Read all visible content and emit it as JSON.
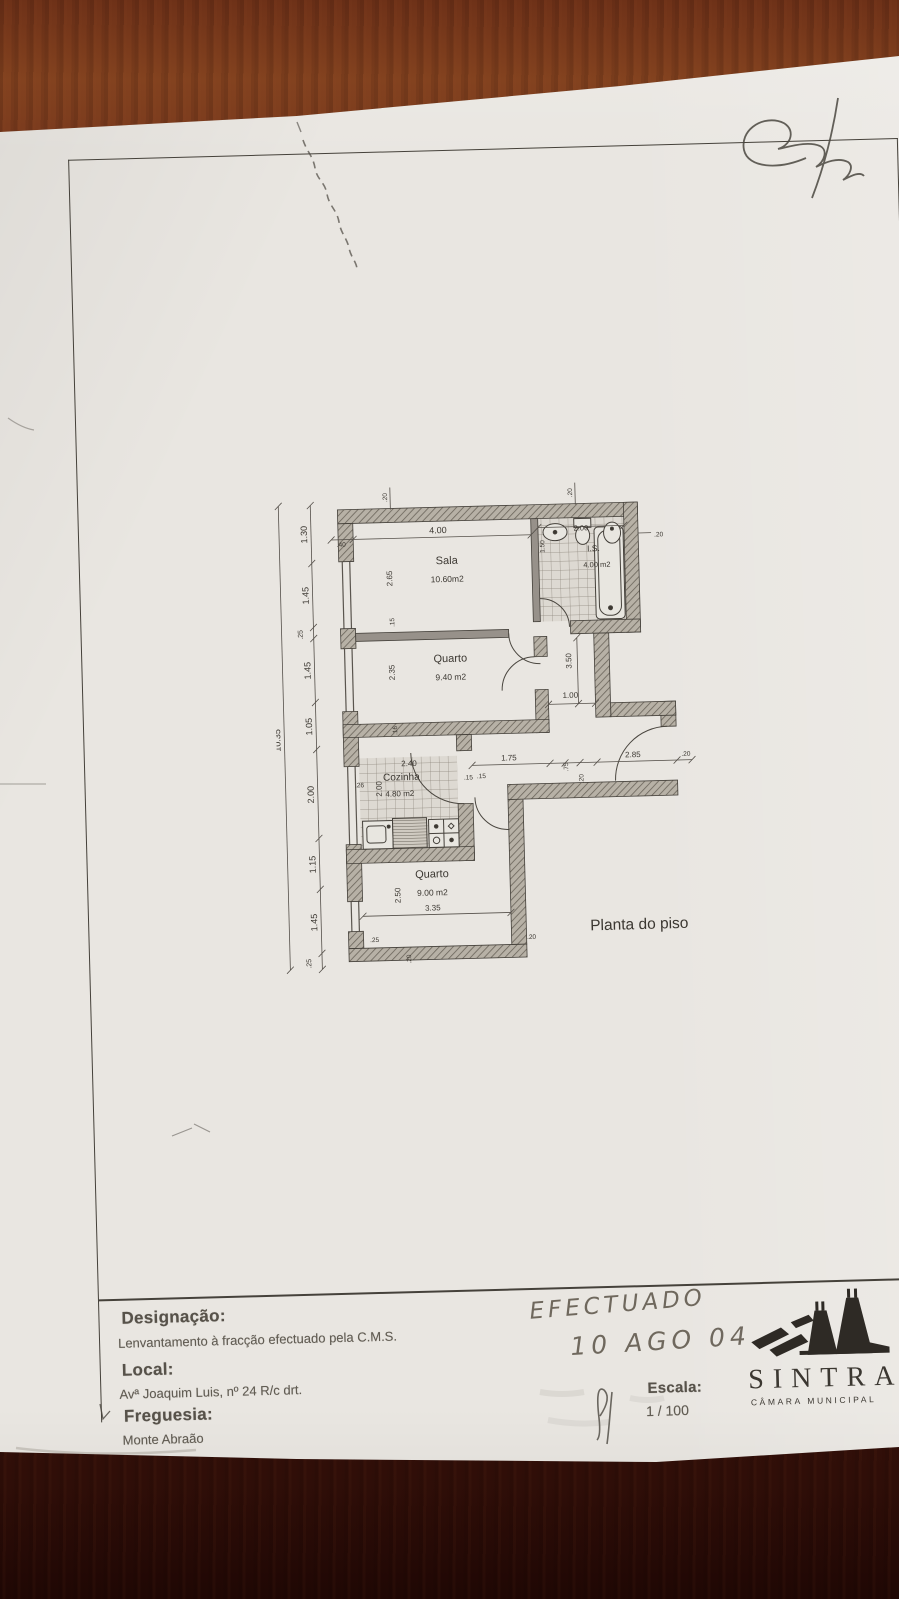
{
  "plan": {
    "title": "Planta do piso",
    "rooms": {
      "sala": {
        "name": "Sala",
        "area": "10.60m2"
      },
      "quarto1": {
        "name": "Quarto",
        "area": "9.40 m2"
      },
      "cozinha": {
        "name": "Cozinha",
        "area": "4.80 m2"
      },
      "quarto2": {
        "name": "Quarto",
        "area": "9.00 m2"
      },
      "is": {
        "name": "I.S.",
        "area": "4.00 m2"
      }
    },
    "dims": {
      "overall_height": "10.35",
      "left_chain": [
        "1.30",
        "1.45",
        ".25",
        "1.45",
        "1.05",
        "2.00",
        "1.15",
        "1.45",
        ".25"
      ],
      "top_width": "4.00",
      "top_left_pier": ".40",
      "wall_20_a": ".20",
      "wall_20_b": ".20",
      "bath_width": "2.00",
      "bath_door": "1.50",
      "bath_right": ".20",
      "sala_depth": "2.65",
      "sala_wall": ".15",
      "quarto1_depth": "2.35",
      "quarto1_wall": ".16",
      "hall_depth": "3.50",
      "hall_width": "1.00",
      "cozinha_width": "2.40",
      "cozinha_depth": "2.00",
      "cozinha_wall": ".26",
      "cozinha_door": ".15",
      "corr_a": "1.75",
      "corr_b": ".15",
      "corr_c": ".75",
      "corr_d": ".20",
      "corr_e": "2.85",
      "corr_f": ".20",
      "quarto2_depth": "2.50",
      "quarto2_width": "3.35",
      "quarto2_a": ".25",
      "quarto2_b": ".20",
      "quarto2_c": ".20"
    }
  },
  "titleblock": {
    "designacao_label": "Designação:",
    "designacao_value": "Lenvantamento à fracção efectuado pela C.M.S.",
    "local_label": "Local:",
    "local_value": "Avª Joaquim Luis, nº 24 R/c drt.",
    "freguesia_label": "Freguesia:",
    "freguesia_value": "Monte Abraão",
    "escala_label": "Escala:",
    "escala_value": "1 / 100",
    "handwriting_line1": "EFECTUADO",
    "handwriting_line2": "10 AGO 04",
    "logo_name": "SINTRA",
    "logo_subtitle": "CÂMARA MUNICIPAL"
  }
}
